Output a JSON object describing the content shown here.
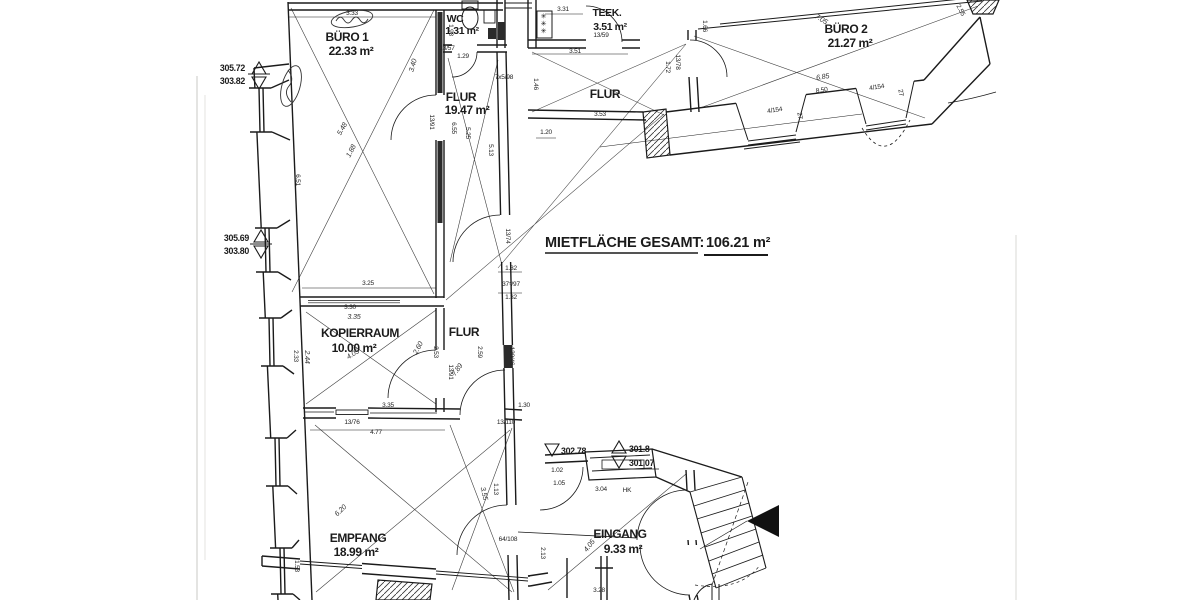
{
  "title": {
    "label": "MIETFLÄCHE GESAMT:",
    "value": "106.21 m²"
  },
  "rooms": [
    {
      "name": "BÜRO 1",
      "area": "22.33 m²"
    },
    {
      "name": "WC",
      "area": "1.31 m²"
    },
    {
      "name": "FLUR",
      "area": "19.47 m²"
    },
    {
      "name": "TEEK.",
      "area": "3.51 m²"
    },
    {
      "name": "BÜRO 2",
      "area": "21.27 m²"
    },
    {
      "name": "FLUR",
      "area": ""
    },
    {
      "name": "KOPIERRAUM",
      "area": "10.00 m²"
    },
    {
      "name": "FLUR",
      "area": ""
    },
    {
      "name": "EMPFANG",
      "area": "18.99 m²"
    },
    {
      "name": "EINGANG",
      "area": "9.33 m²"
    }
  ],
  "fixtures": {
    "stove_symbols": "✳✳✳"
  },
  "elevations": [
    {
      "t": "305.72",
      "x": 245,
      "y": 71,
      "a": "end"
    },
    {
      "t": "303.82",
      "x": 245,
      "y": 84,
      "a": "end"
    },
    {
      "t": "305.69",
      "x": 249,
      "y": 241,
      "a": "end"
    },
    {
      "t": "303.80",
      "x": 249,
      "y": 254,
      "a": "end"
    },
    {
      "t": "302.78",
      "x": 561,
      "y": 454,
      "a": "start"
    },
    {
      "t": "301.8",
      "x": 629,
      "y": 452,
      "a": "start"
    },
    {
      "t": "301.07",
      "x": 629,
      "y": 466,
      "a": "start"
    }
  ],
  "dimensions": [
    {
      "t": "3.33",
      "x": 352,
      "y": 15,
      "r": 0
    },
    {
      "t": "3.31",
      "x": 563,
      "y": 11,
      "r": 0
    },
    {
      "t": "13/57",
      "x": 447,
      "y": 50,
      "r": 0
    },
    {
      "t": "1.29",
      "x": 463,
      "y": 58,
      "r": 0
    },
    {
      "t": "1.93",
      "x": 449,
      "y": 30,
      "r": 90
    },
    {
      "t": "13/59",
      "x": 601,
      "y": 37,
      "r": 0
    },
    {
      "t": "3.51",
      "x": 575,
      "y": 53,
      "r": 0
    },
    {
      "t": "3.53",
      "x": 600,
      "y": 116,
      "r": 0
    },
    {
      "t": "1.20",
      "x": 546,
      "y": 134,
      "r": 0
    },
    {
      "t": "1.46",
      "x": 534,
      "y": 84,
      "r": 90
    },
    {
      "t": "1.66",
      "x": 703,
      "y": 26,
      "r": 90
    },
    {
      "t": "1.72",
      "x": 666,
      "y": 67,
      "r": 90
    },
    {
      "t": "13/78",
      "x": 676,
      "y": 62,
      "r": 90
    },
    {
      "t": "7x5/98",
      "x": 504,
      "y": 79,
      "r": 0
    },
    {
      "t": "6.51",
      "x": 296,
      "y": 180,
      "r": 90
    },
    {
      "t": "6.55",
      "x": 452,
      "y": 128,
      "r": 90
    },
    {
      "t": "5.25",
      "x": 466,
      "y": 133,
      "r": 90
    },
    {
      "t": "5.13",
      "x": 489,
      "y": 150,
      "r": 90
    },
    {
      "t": "1.88",
      "x": 353,
      "y": 152,
      "r": -62,
      "h": true
    },
    {
      "t": "3.40",
      "x": 415,
      "y": 66,
      "r": -75,
      "h": true
    },
    {
      "t": "5.48",
      "x": 344,
      "y": 130,
      "r": -60,
      "h": true
    },
    {
      "t": "13/91",
      "x": 430,
      "y": 122,
      "r": 90
    },
    {
      "t": "3.25",
      "x": 368,
      "y": 285,
      "r": 0
    },
    {
      "t": "1.32",
      "x": 511,
      "y": 270,
      "r": 0
    },
    {
      "t": "37⁵/97",
      "x": 511,
      "y": 286,
      "r": 0
    },
    {
      "t": "1.32",
      "x": 511,
      "y": 299,
      "r": 0
    },
    {
      "t": "13/74",
      "x": 506,
      "y": 236,
      "r": 90
    },
    {
      "t": "3.30",
      "x": 350,
      "y": 309,
      "r": 0
    },
    {
      "t": "3.35",
      "x": 354,
      "y": 319,
      "r": 0,
      "h": true
    },
    {
      "t": "2.53",
      "x": 434,
      "y": 352,
      "r": 90
    },
    {
      "t": "2.60",
      "x": 420,
      "y": 349,
      "r": -62,
      "h": true
    },
    {
      "t": "2.59",
      "x": 478,
      "y": 352,
      "r": 90
    },
    {
      "t": "7.89",
      "x": 459,
      "y": 371,
      "r": -55,
      "h": true
    },
    {
      "t": "120/46",
      "x": 510,
      "y": 356,
      "r": 90
    },
    {
      "t": "2.33",
      "x": 294,
      "y": 356,
      "r": 90
    },
    {
      "t": "2.44",
      "x": 305,
      "y": 357,
      "r": 90,
      "h": true
    },
    {
      "t": "4.05",
      "x": 354,
      "y": 356,
      "r": -32,
      "h": true
    },
    {
      "t": "3.35",
      "x": 388,
      "y": 407,
      "r": 0
    },
    {
      "t": "13/76",
      "x": 352,
      "y": 424,
      "r": 0
    },
    {
      "t": "4.77",
      "x": 376,
      "y": 434,
      "r": 0
    },
    {
      "t": "1.30",
      "x": 524,
      "y": 407,
      "r": 0
    },
    {
      "t": "13/110",
      "x": 506,
      "y": 424,
      "r": 0
    },
    {
      "t": "13/91",
      "x": 449,
      "y": 372,
      "r": 90
    },
    {
      "t": "6.20",
      "x": 342,
      "y": 512,
      "r": -44,
      "h": true
    },
    {
      "t": "1.53",
      "x": 295,
      "y": 566,
      "r": 90
    },
    {
      "t": "3.55",
      "x": 482,
      "y": 494,
      "r": 78,
      "h": true
    },
    {
      "t": "1.13",
      "x": 494,
      "y": 489,
      "r": 90
    },
    {
      "t": "64/108",
      "x": 508,
      "y": 541,
      "r": 0
    },
    {
      "t": "3.04",
      "x": 601,
      "y": 491,
      "r": 0
    },
    {
      "t": "1.02",
      "x": 557,
      "y": 472,
      "r": 0
    },
    {
      "t": "1.05",
      "x": 559,
      "y": 485,
      "r": 0
    },
    {
      "t": "HK",
      "x": 627,
      "y": 492,
      "r": 0
    },
    {
      "t": "3.28",
      "x": 599,
      "y": 592,
      "r": 0
    },
    {
      "t": "4.05",
      "x": 591,
      "y": 547,
      "r": -52,
      "h": true
    },
    {
      "t": "2.13",
      "x": 541,
      "y": 553,
      "r": 90
    },
    {
      "t": "6.85",
      "x": 823,
      "y": 79,
      "r": -9,
      "h": true
    },
    {
      "t": "8.50",
      "x": 822,
      "y": 92,
      "r": -9
    },
    {
      "t": "4/154",
      "x": 775,
      "y": 112,
      "r": -9
    },
    {
      "t": "27",
      "x": 798,
      "y": 116,
      "r": 80
    },
    {
      "t": "4/154",
      "x": 877,
      "y": 89,
      "r": -9
    },
    {
      "t": "27",
      "x": 899,
      "y": 93,
      "r": 80
    },
    {
      "t": "7.05",
      "x": 820,
      "y": 21,
      "r": 32,
      "h": true
    },
    {
      "t": "2.55",
      "x": 959,
      "y": 11,
      "r": 62
    }
  ]
}
